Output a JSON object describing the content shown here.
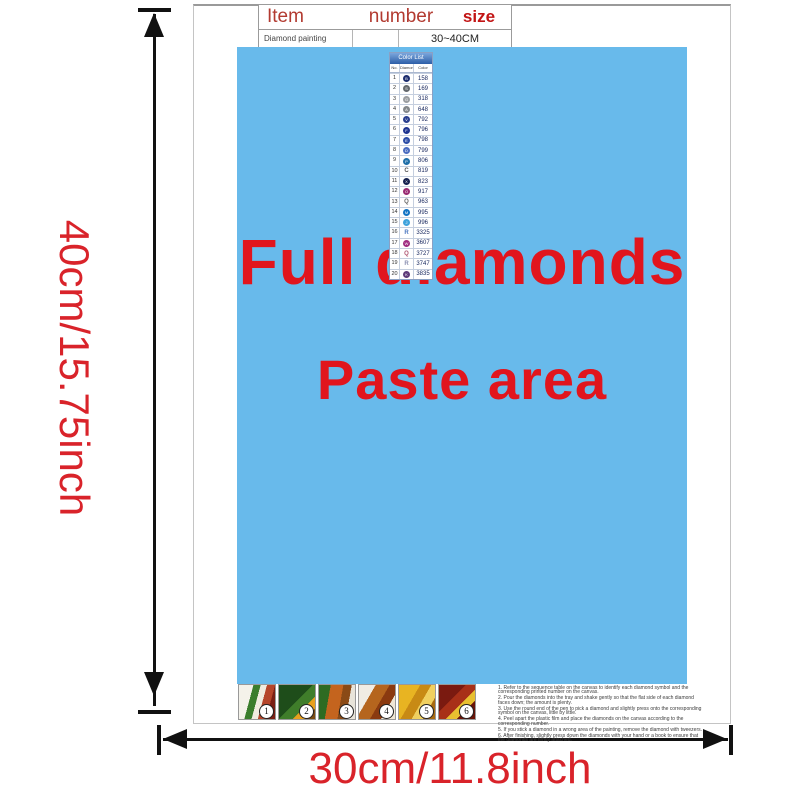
{
  "colors": {
    "paste_blue": "#68baeb",
    "title_red": "#e1151d",
    "dim_red": "#d9232a",
    "table_header_red": "#b23a30",
    "size_red": "#c21414",
    "list_header_blue": "#2d5fa8",
    "arrow_black": "#111111"
  },
  "dimensions": {
    "height_label": "40cm/15.75inch",
    "width_label": "30cm/11.8inch"
  },
  "item_table": {
    "col_item": "Item",
    "col_number": "number",
    "col_size": "size",
    "row_name": "Diamond painting",
    "row_number": "",
    "row_size": "30~40CM"
  },
  "paste_area": {
    "line1": "Full diamonds",
    "line2": "Paste area"
  },
  "color_list": {
    "title": "Color List",
    "col_no": "No.",
    "col_diamond": "Diamond",
    "col_color": "Color",
    "rows": [
      {
        "no": "1",
        "code": "158",
        "letter": "B",
        "fill": "#1c2d6e"
      },
      {
        "no": "2",
        "code": "169",
        "letter": "S",
        "fill": "#63686d"
      },
      {
        "no": "3",
        "code": "318",
        "letter": "G",
        "fill": "#9a9da0"
      },
      {
        "no": "4",
        "code": "648",
        "letter": "A",
        "fill": "#83878a"
      },
      {
        "no": "5",
        "code": "792",
        "letter": "V",
        "fill": "#2a3f8f"
      },
      {
        "no": "6",
        "code": "796",
        "letter": "F",
        "fill": "#1e3490"
      },
      {
        "no": "7",
        "code": "798",
        "letter": "E",
        "fill": "#2c4da6"
      },
      {
        "no": "8",
        "code": "799",
        "letter": "D",
        "fill": "#4a6cc0"
      },
      {
        "no": "9",
        "code": "806",
        "letter": "P",
        "fill": "#1f6fa8"
      },
      {
        "no": "10",
        "code": "819",
        "letter": "C",
        "color": "#555555"
      },
      {
        "no": "11",
        "code": "823",
        "letter": "X",
        "fill": "#14204e"
      },
      {
        "no": "12",
        "code": "917",
        "letter": "O",
        "fill": "#992a72"
      },
      {
        "no": "13",
        "code": "963",
        "letter": "Q",
        "color": "#666666"
      },
      {
        "no": "14",
        "code": "995",
        "letter": "M",
        "fill": "#1374c4"
      },
      {
        "no": "15",
        "code": "996",
        "letter": "J",
        "fill": "#3fa3dc"
      },
      {
        "no": "16",
        "code": "3325",
        "letter": "R",
        "color": "#4a77c0"
      },
      {
        "no": "17",
        "code": "3607",
        "letter": "W",
        "fill": "#a02c80"
      },
      {
        "no": "18",
        "code": "3727",
        "letter": "Q",
        "color": "#b05570"
      },
      {
        "no": "19",
        "code": "3747",
        "letter": "R",
        "color": "#8a8fb0"
      },
      {
        "no": "20",
        "code": "3835",
        "letter": "K",
        "fill": "#5e3a78"
      }
    ]
  },
  "steps": [
    {
      "num": "1"
    },
    {
      "num": "2"
    },
    {
      "num": "3"
    },
    {
      "num": "4"
    },
    {
      "num": "5"
    },
    {
      "num": "6"
    }
  ],
  "instructions": {
    "lines": [
      "1. Refer to the sequence table on the canvas to identify each diamond symbol and the corresponding printed number on the canvas.",
      "2. Pour the diamonds into the tray and shake gently so that the flat side of each diamond faces down; the amount is plenty.",
      "3. Use the round end of the pen to pick a diamond and slightly press onto the corresponding symbol on the canvas, little by little.",
      "4. Peel apart the plastic film and place the diamonds on the canvas according to the corresponding number.",
      "5. If you stick a diamond in a wrong area of the painting, remove the diamond with tweezers.",
      "6. After finishing, slightly press down the diamonds with your hand or a book to ensure that the diamonds are firmly attached."
    ]
  }
}
